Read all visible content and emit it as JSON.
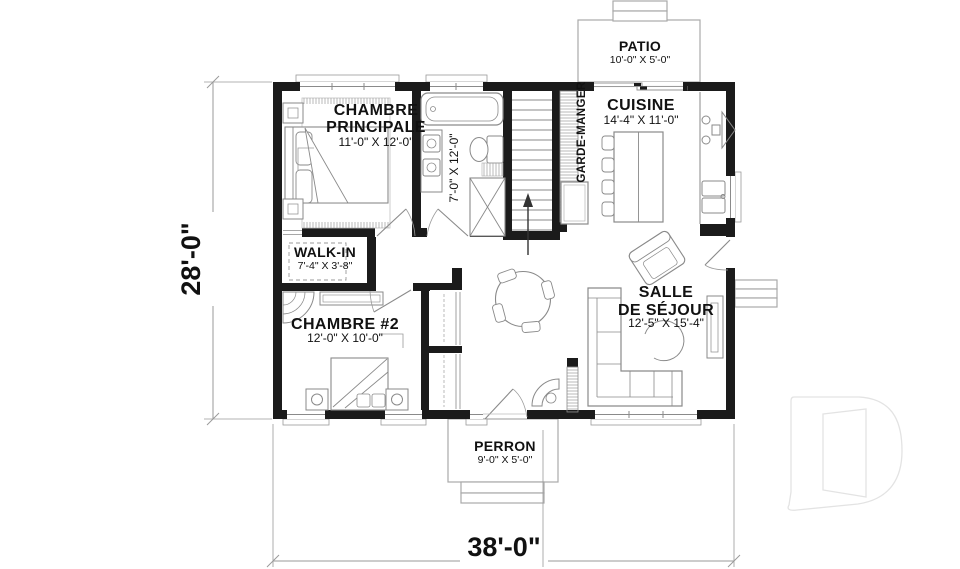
{
  "rooms": {
    "master_bedroom": {
      "name": "CHAMBRE",
      "name2": "PRINCIPALE",
      "dims": "11'-0\" X 12'-0\""
    },
    "bathroom": {
      "dims": "7'-0\" X 12'-0\""
    },
    "pantry": {
      "name": "GARDE-MANGER"
    },
    "kitchen": {
      "name": "CUISINE",
      "dims": "14'-4\" X 11'-0\""
    },
    "patio": {
      "name": "PATIO",
      "dims": "10'-0\" X 5'-0\""
    },
    "walk_in": {
      "name": "WALK-IN",
      "dims": "7'-4\" X 3'-8\""
    },
    "bedroom2": {
      "name": "CHAMBRE #2",
      "dims": "12'-0\" X 10'-0\""
    },
    "living_room": {
      "name": "SALLE",
      "name2": "DE SÉJOUR",
      "dims": "12'-5\" X 15'-4\""
    },
    "porch": {
      "name": "PERRON",
      "dims": "9'-0\" X 5'-0\""
    }
  },
  "overall": {
    "width": "38'-0\"",
    "height": "28'-0\""
  },
  "watermark": {
    "logo_letter": "D"
  },
  "colors": {
    "walls": "#1b1b1b",
    "lines": "#8a8a8a",
    "dim_lines": "#9a9a9a",
    "text": "#111111",
    "watermark_outline": "#e3e3e3",
    "background": "#ffffff"
  }
}
